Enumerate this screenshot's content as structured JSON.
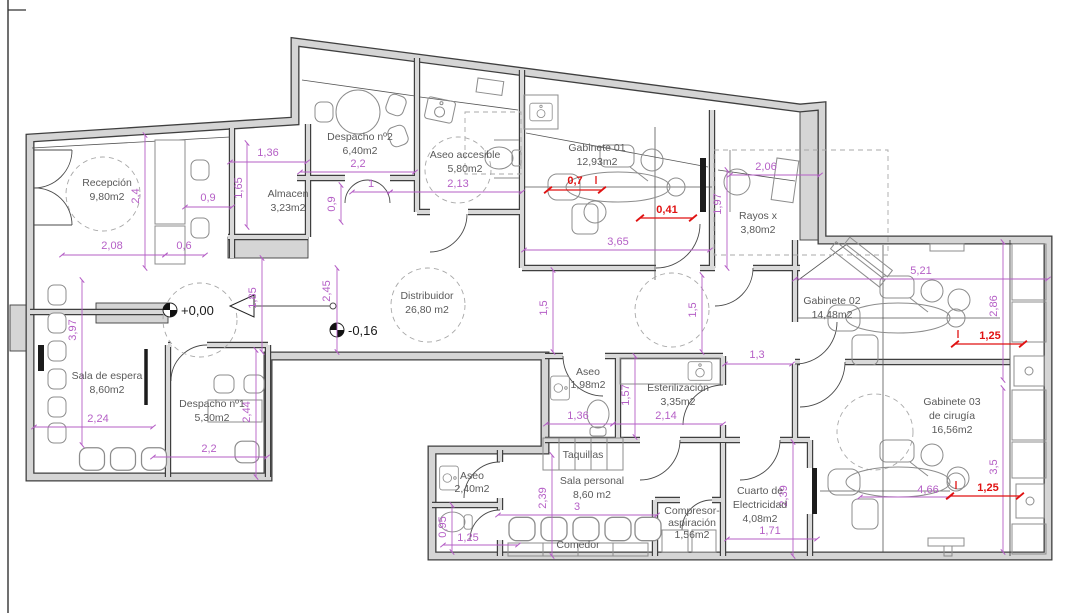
{
  "drawing": {
    "type": "floor-plan",
    "units": "m",
    "area_suffix": "m2"
  },
  "rooms": [
    {
      "name": "Recepción",
      "area": "9,80m2"
    },
    {
      "name": "Almacen",
      "area": "3,23m2"
    },
    {
      "name": "Despacho nº2",
      "area": "6,40m2"
    },
    {
      "name": "Aseo accesible",
      "area": "5,80m2"
    },
    {
      "name": "Gabinete 01",
      "area": "12,93m2"
    },
    {
      "name": "Rayos x",
      "area": "3,80m2"
    },
    {
      "name": "Distribuidor",
      "area": "26,80 m2"
    },
    {
      "name": "Gabinete 02",
      "area": "14,48m2"
    },
    {
      "name": "Gabinete 03",
      "name2": "de cirugía",
      "area": "16,56m2"
    },
    {
      "name": "Sala de espera",
      "area": "8,60m2"
    },
    {
      "name": "Despacho nº1",
      "area": "5,30m2"
    },
    {
      "name": "Aseo",
      "area": "1,98m2"
    },
    {
      "name": "Esterilización",
      "area": "3,35m2"
    },
    {
      "name": "Aseo",
      "area": "2,40m2"
    },
    {
      "name": "Taquillas"
    },
    {
      "name": "Sala personal",
      "area": "8,60 m2"
    },
    {
      "name": "Comedor"
    },
    {
      "name": "Compresor-",
      "name2": "aspiración",
      "area": "1,56m2"
    },
    {
      "name": "Cuarto de",
      "name2": "Electricidad",
      "area": "4,08m2"
    }
  ],
  "levels": [
    {
      "label": "+0,00"
    },
    {
      "label": "-0,16"
    }
  ],
  "dims": [
    "1,36",
    "1,65",
    "0,9",
    "2,08",
    "0,6",
    "2,4",
    "2,2",
    "1",
    "0,9",
    "2,13",
    "2,45",
    "1,85",
    "0,7",
    "0,41",
    "3,65",
    "1,97",
    "2,06",
    "1,5",
    "1,5",
    "1,3",
    "5,21",
    "2,86",
    "1,25",
    "3,5",
    "1,25",
    "4,66",
    "3,97",
    "2,24",
    "2,44",
    "2,2",
    "1,57",
    "2,14",
    "1,36",
    "2,39",
    "3",
    "2,39",
    "1,71",
    "0,95",
    "1,25"
  ],
  "colors": {
    "dimension": "#b55fc6",
    "critical_dimension": "#e01212",
    "wall_fill": "#d5d5d5",
    "wall_edge": "#3f3f3f",
    "furniture": "#8c8c8c",
    "room_text": "#5a5a5a"
  }
}
